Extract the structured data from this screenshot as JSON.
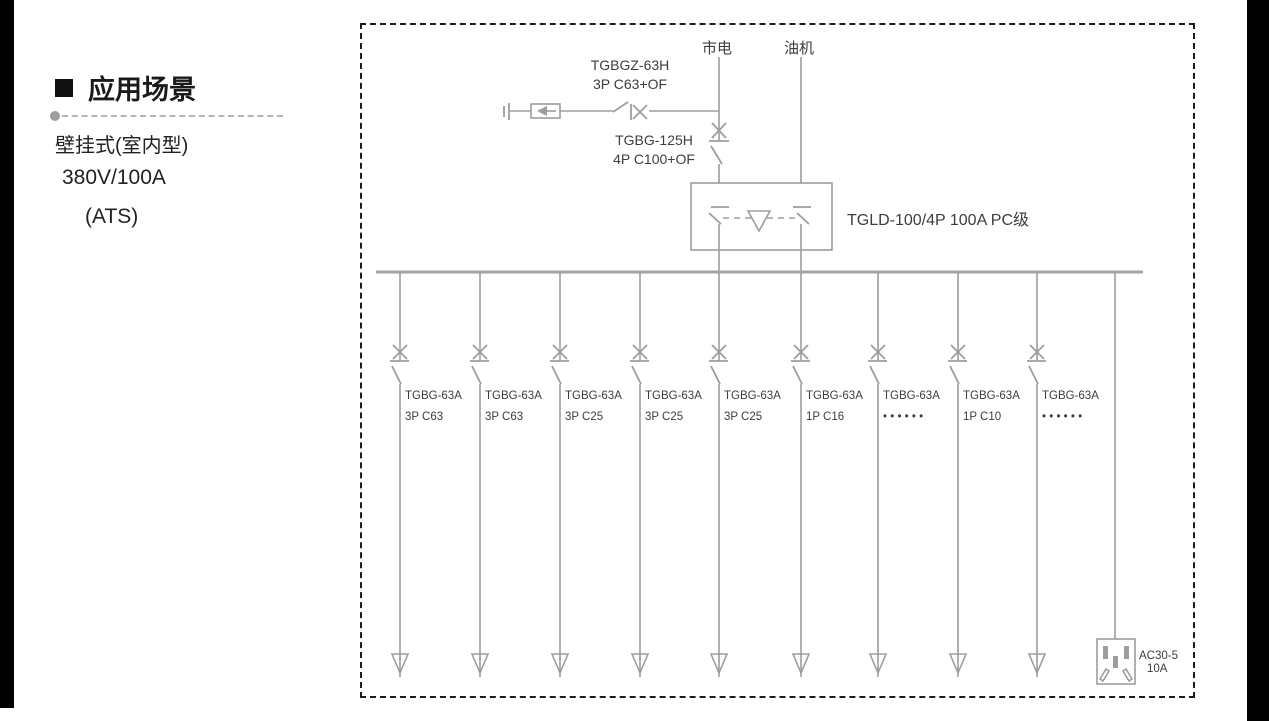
{
  "sidebar": {
    "heading": "应用场景",
    "line1": "壁挂式(室内型)",
    "line2": "380V/100A",
    "line3": "(ATS)"
  },
  "diagram": {
    "source_main": "市电",
    "source_generator": "油机",
    "spd_breaker": {
      "model": "TGBGZ-63H",
      "spec": "3P C63+OF"
    },
    "incoming_breaker": {
      "model": "TGBG-125H",
      "spec": "4P C100+OF"
    },
    "ats_label": "TGLD-100/4P 100A PC级",
    "branches": [
      {
        "model": "TGBG-63A",
        "spec": "3P C63"
      },
      {
        "model": "TGBG-63A",
        "spec": "3P C63"
      },
      {
        "model": "TGBG-63A",
        "spec": "3P C25"
      },
      {
        "model": "TGBG-63A",
        "spec": "3P C25"
      },
      {
        "model": "TGBG-63A",
        "spec": "3P C25"
      },
      {
        "model": "TGBG-63A",
        "spec": "1P C16"
      },
      {
        "model": "TGBG-63A",
        "spec": "• • • • • •"
      },
      {
        "model": "TGBG-63A",
        "spec": "1P C10"
      },
      {
        "model": "TGBG-63A",
        "spec": "• • • • • •"
      }
    ],
    "socket": {
      "model": "AC30-5",
      "rating": "10A"
    }
  },
  "colors": {
    "wire": "#9d9d9d",
    "bus": "#a4a4a4",
    "diagram_text": "#3d3d3d",
    "sidebar_text": "#1a1a1a",
    "frame": "#1c1c1c",
    "separator": "#b5b5b5",
    "bar": "#000000"
  }
}
